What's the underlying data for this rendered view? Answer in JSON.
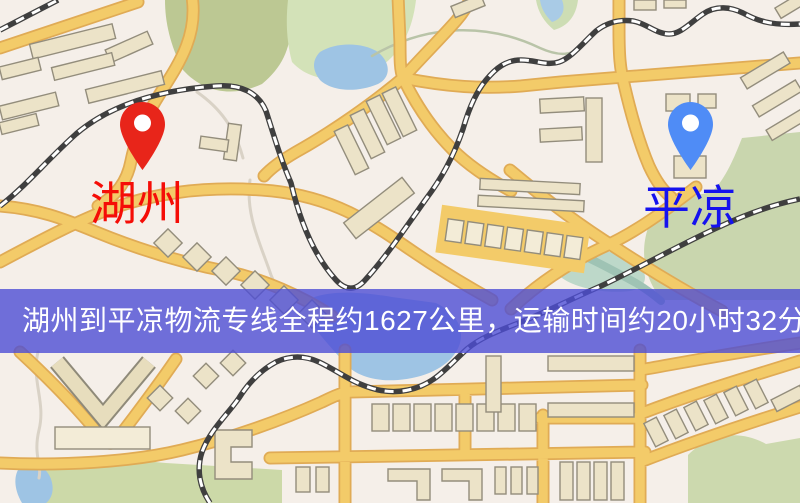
{
  "map": {
    "origin": {
      "label": "湖州",
      "pin_color": "#e8251a",
      "label_color": "#f50d07"
    },
    "destination": {
      "label": "平凉",
      "pin_color": "#4f8cf6",
      "label_color": "#1512ee"
    },
    "colors": {
      "background": "#f5efe9",
      "road": "#f3cb69",
      "road_casing": "#e0ab55",
      "building_fill": "#ece3c8",
      "building_stroke": "#938d7c",
      "green_light": "#d3e2b8",
      "green_dark": "#bcc893",
      "green_sage": "#c9d6ae",
      "water": "#9ec4e4",
      "water_teal": "#bdd8c9",
      "railway": "#3f3f3f",
      "banner": "#4d4dd4",
      "banner_text": "#ffffff"
    }
  },
  "banner": {
    "text": "湖州到平凉物流专线全程约1627公里，运输时间约20小时32分钟.",
    "distance_km": "1627",
    "duration": "20小时32分钟"
  }
}
